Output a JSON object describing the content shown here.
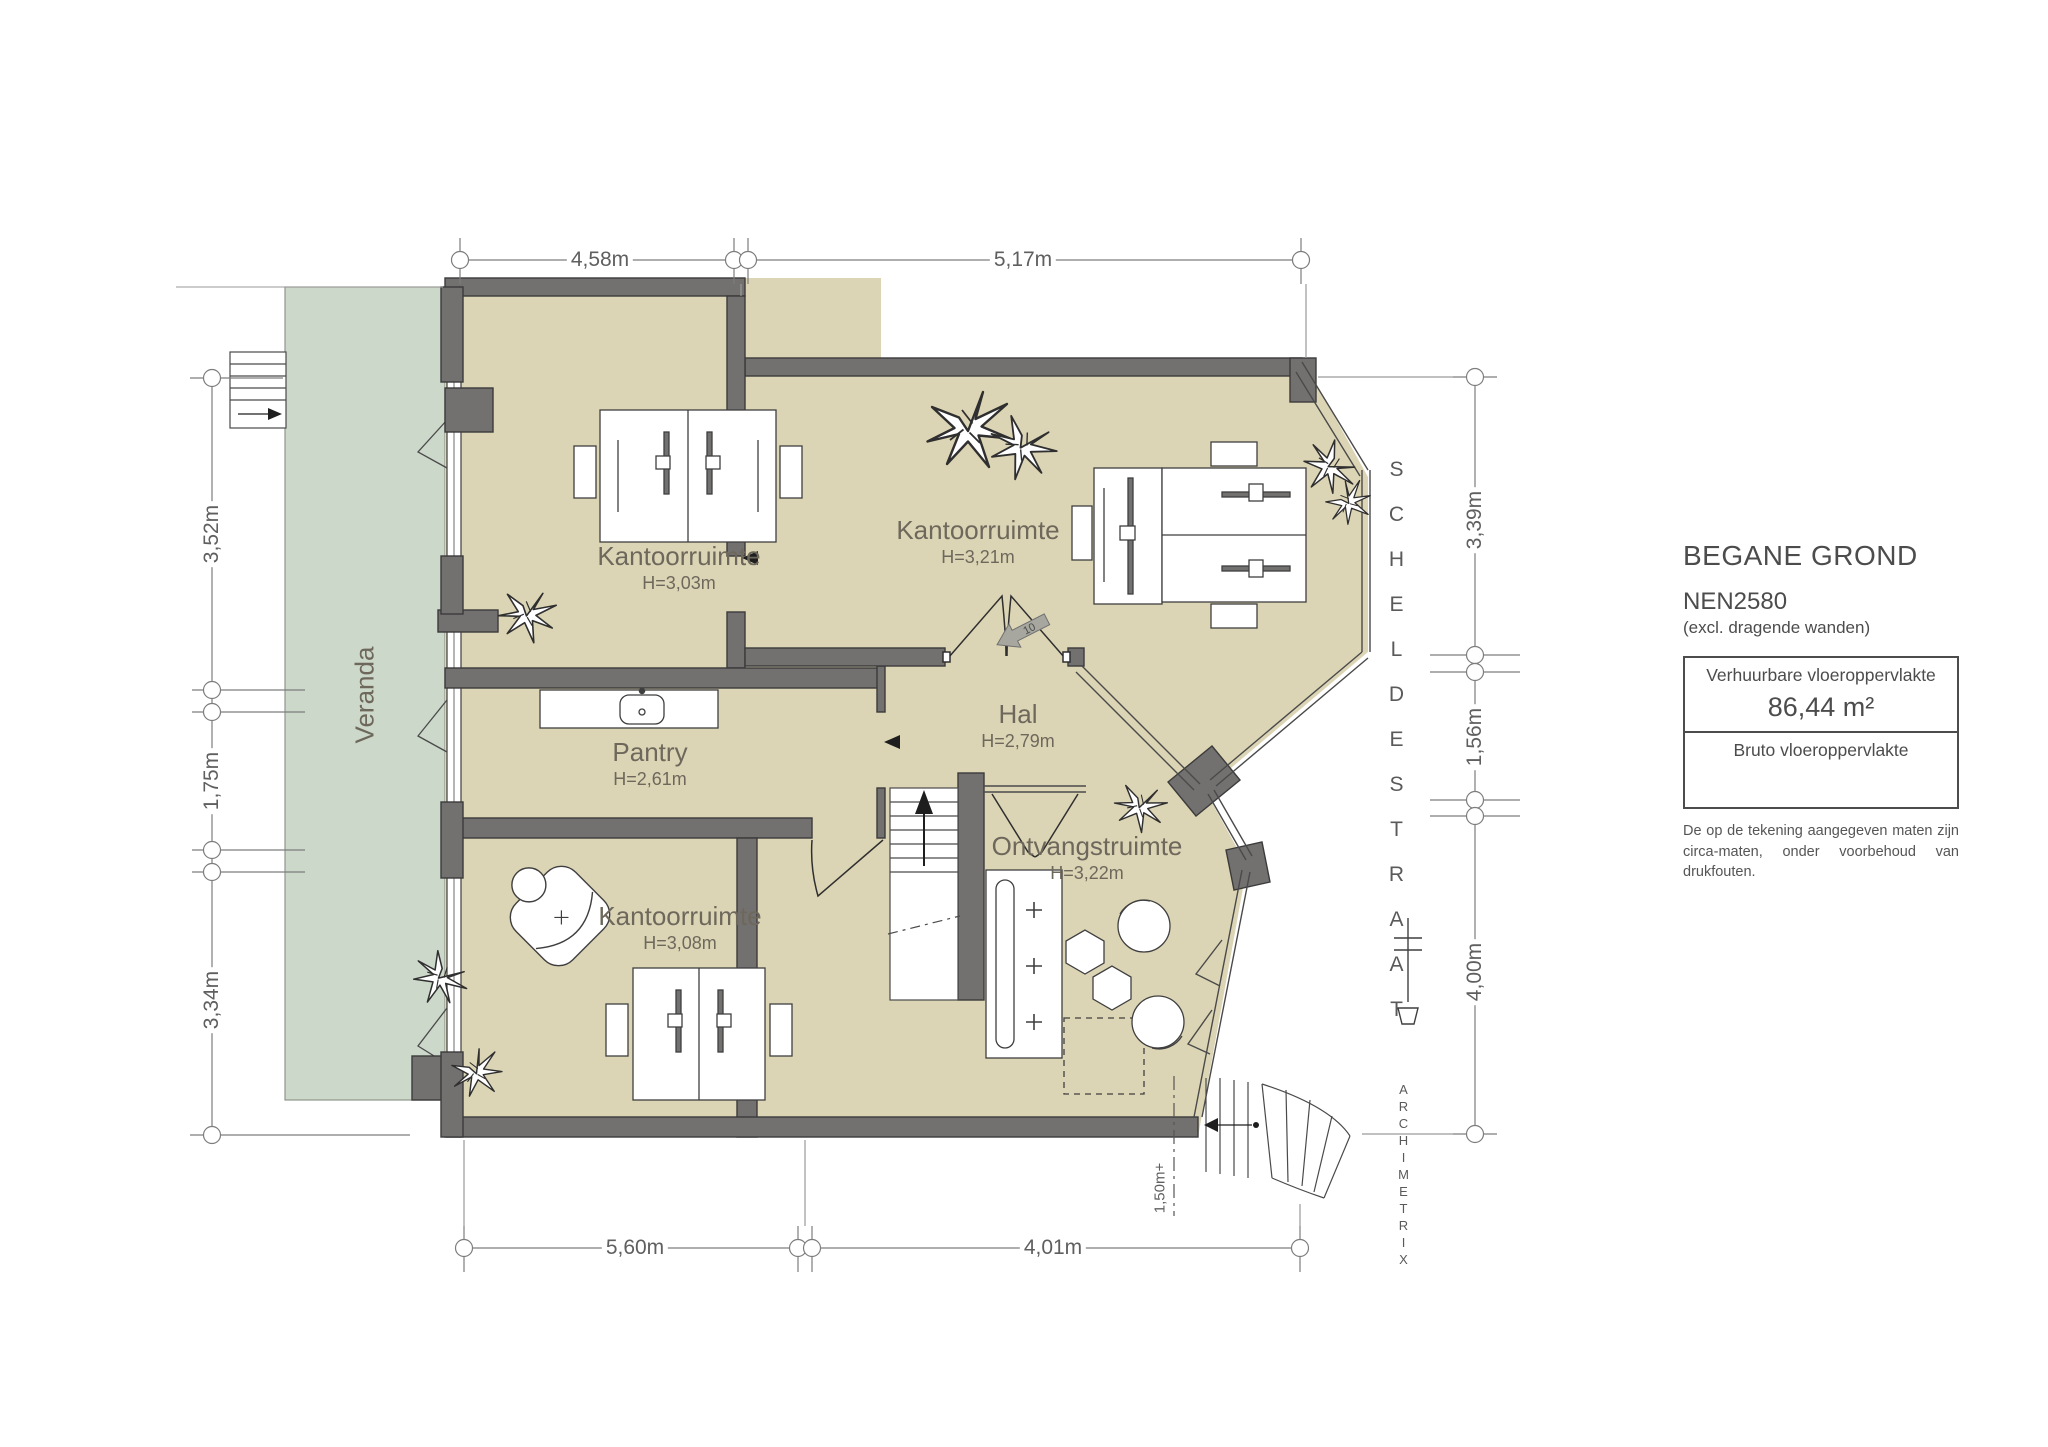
{
  "plan": {
    "rooms": [
      {
        "name": "Kantoorruimte",
        "height": "H=3,03m"
      },
      {
        "name": "Kantoorruimte",
        "height": "H=3,21m"
      },
      {
        "name": "Pantry",
        "height": "H=2,61m"
      },
      {
        "name": "Hal",
        "height": "H=2,79m"
      },
      {
        "name": "Kantoorruimte",
        "height": "H=3,08m"
      },
      {
        "name": "Ontvangstruimte",
        "height": "H=3,22m"
      },
      {
        "name": "Veranda"
      }
    ],
    "dimensions": {
      "top": [
        "4,58m",
        "5,17m"
      ],
      "left": [
        "3,52m",
        "1,75m",
        "3,34m"
      ],
      "right": [
        "3,39m",
        "1,56m",
        "4,00m"
      ],
      "bottom": [
        "5,60m",
        "4,01m"
      ]
    },
    "markers": {
      "level": "1,50m+",
      "entrance_number": "10"
    },
    "streets": {
      "street_name": "SCHELDESTRAAT",
      "firm_name": "ARCHIMETRIX"
    },
    "title_block": {
      "title": "BEGANE GROND",
      "norm": "NEN2580",
      "norm_note": "(excl. dragende wanden)",
      "rentable_label": "Verhuurbare vloeroppervlakte",
      "rentable_value": "86,44 m²",
      "gross_label": "Bruto vloeroppervlakte",
      "disclaimer": "De op de tekening aangegeven maten zijn circa-maten, onder voorbehoud van drukfouten."
    },
    "colors": {
      "room_fill": "#DCD5B5",
      "veranda_fill": "#CCD8C9",
      "wall": "#737070",
      "line": "#4a4a4a",
      "dimension": "#7d7d7d"
    }
  }
}
